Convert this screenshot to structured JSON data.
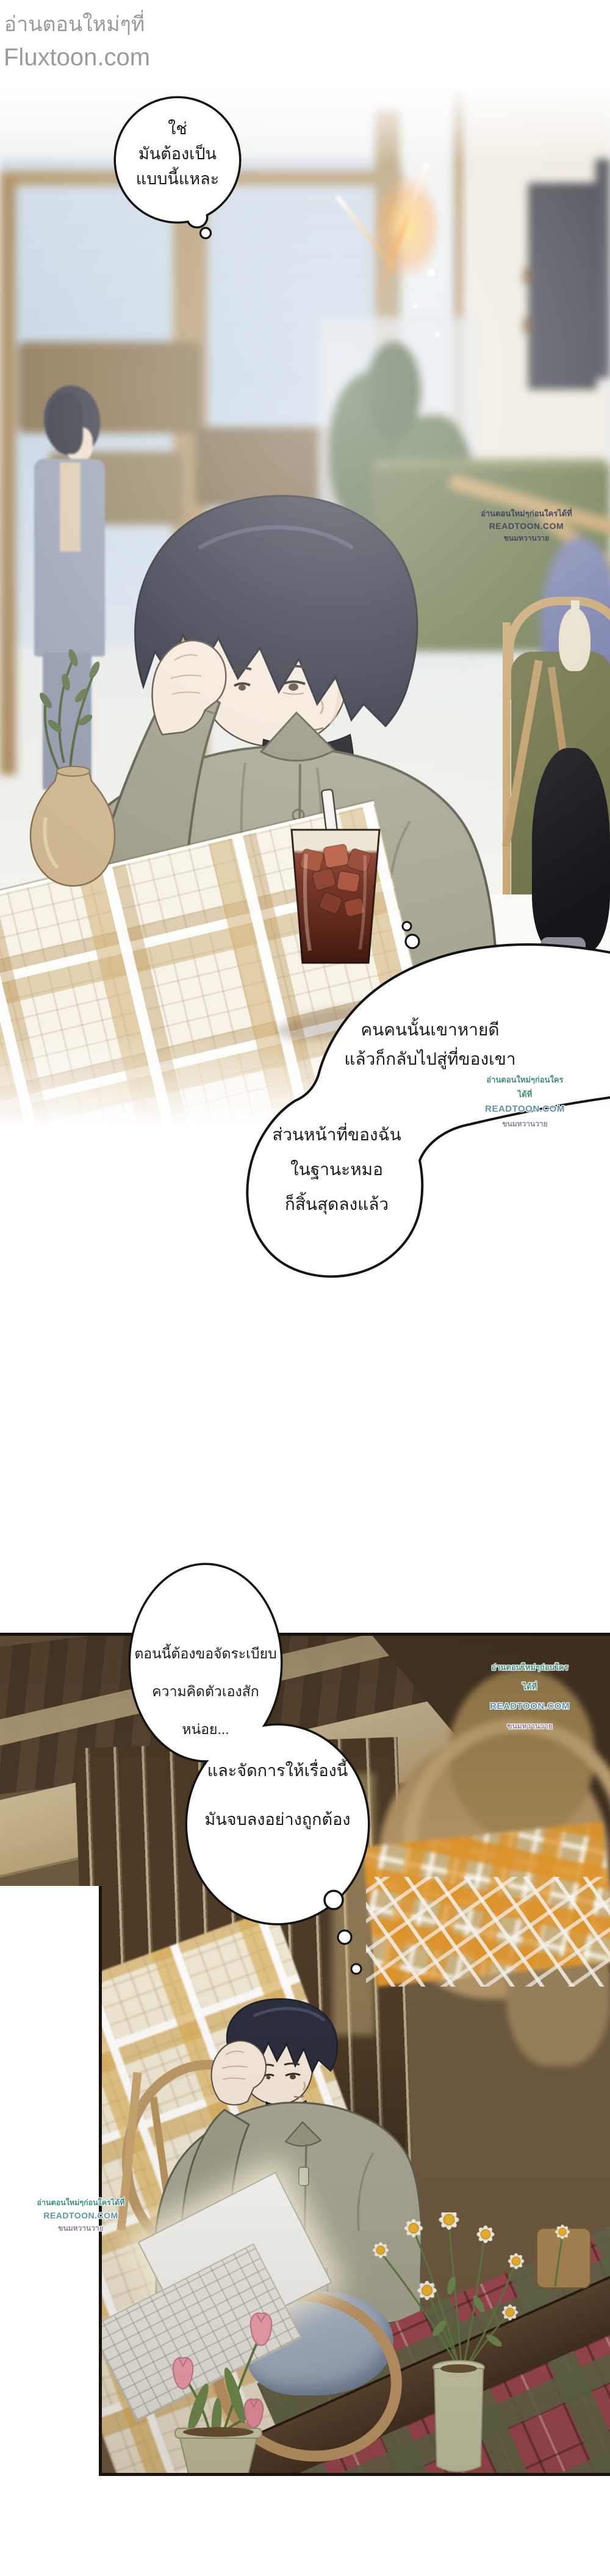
{
  "header": {
    "line1": "อ่านตอนใหม่ๆที่",
    "line2": "Fluxtoon.com"
  },
  "bubbles": {
    "b1": {
      "lines": [
        "ใช่",
        "มันต้องเป็น",
        "แบบนี้แหละ"
      ]
    },
    "b2": {
      "lines": [
        "คนคนนั้นเขาหายดี",
        "แล้วก็กลับไปสู่ที่ของเขา"
      ]
    },
    "b3": {
      "lines": [
        "ส่วนหน้าที่ของฉัน",
        "ในฐานะหมอ",
        "ก็สิ้นสุดลงแล้ว"
      ]
    },
    "b4": {
      "lines": [
        "ตอนนี้ต้องขอจัดระเบียบ",
        "ความคิดตัวเองสักหน่อย..."
      ]
    },
    "b5": {
      "lines": [
        "และจัดการให้เรื่องนี้",
        "มันจบลงอย่างถูกต้อง"
      ]
    }
  },
  "watermark": {
    "line1": "อ่านตอนใหม่ๆก่อนใครได้ที่",
    "line2": "READTOON.COM",
    "line3": "ขนมหวานวาย"
  },
  "colors": {
    "header_gray": "#9b9b9b",
    "bubble_outline": "#141414",
    "watermark_navy": "#3d4360",
    "watermark_teal": "#3f8f7f",
    "watermark_blue": "#5d93ab",
    "watermark_purple": "#93829b",
    "hair_navy": "#2c2f3e",
    "jacket_sage": "#a7a693",
    "turtleneck_black": "#17181d",
    "coffee_brown": "#6b2a1c",
    "cushion_olive": "#6e7144",
    "rattan_tan": "#c8a671",
    "tartan_red": "#9c4750",
    "wood_dark": "#4d3c2a",
    "wood_tan": "#c7b28d"
  }
}
